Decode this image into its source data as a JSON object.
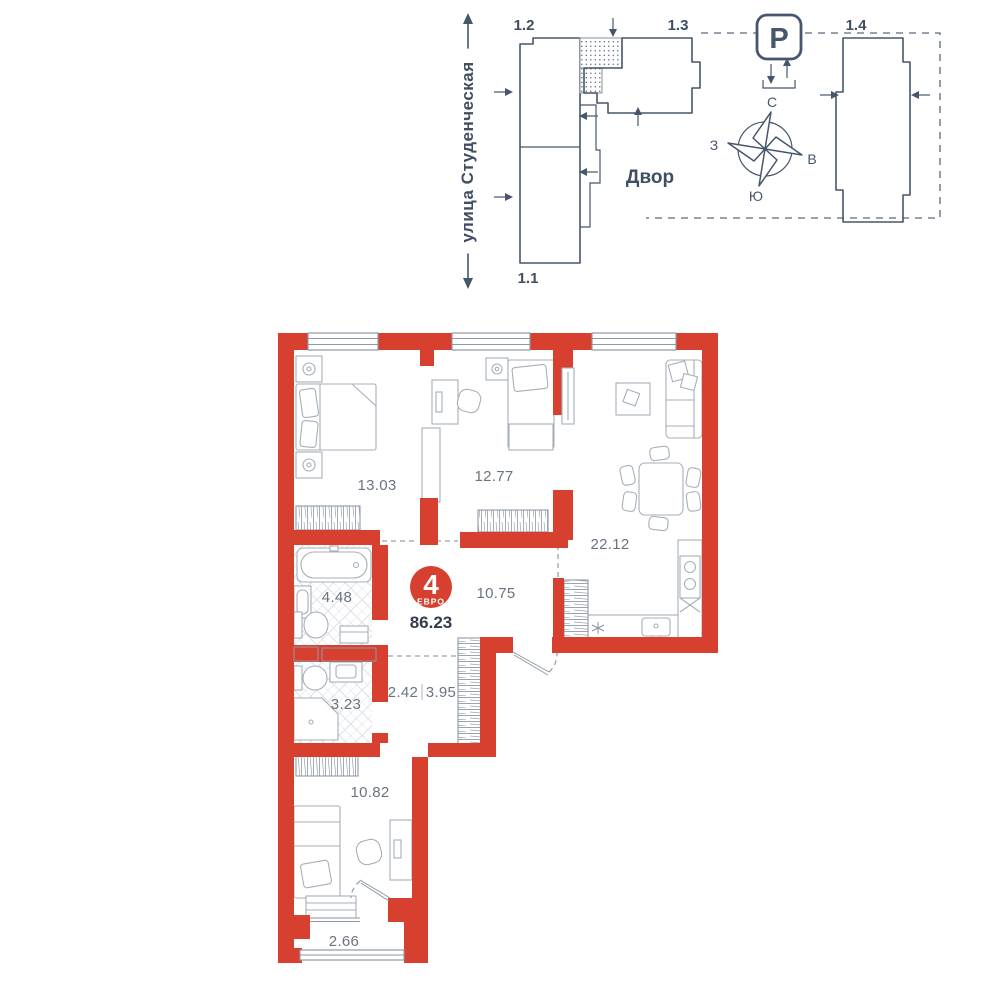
{
  "site_plan": {
    "street_label": "улица Студенческая",
    "courtyard_label": "Двор",
    "parking_label": "P",
    "buildings": {
      "b11": "1.1",
      "b12": "1.2",
      "b13": "1.3",
      "b14": "1.4"
    },
    "compass": {
      "north": "С",
      "south": "Ю",
      "west": "З",
      "east": "В"
    }
  },
  "apartment": {
    "badge": {
      "rooms_count": "4",
      "layout_type": "ЕВРО",
      "total_area": "86.23"
    },
    "rooms": {
      "bedroom_1": {
        "area": "13.03"
      },
      "bedroom_2": {
        "area": "12.77"
      },
      "living_kitchen": {
        "area": "22.12"
      },
      "bathroom_1": {
        "area": "4.48"
      },
      "hallway": {
        "area": "10.75"
      },
      "corridor": {
        "area": "2.42"
      },
      "wardrobe": {
        "area": "3.95"
      },
      "bathroom_2": {
        "area": "3.23"
      },
      "bedroom_3": {
        "area": "10.82"
      },
      "balcony": {
        "area": "2.66"
      }
    }
  },
  "colors": {
    "wall_red": "#d7402e",
    "line_slate": "#46566c",
    "label_gray": "#6a7480"
  }
}
